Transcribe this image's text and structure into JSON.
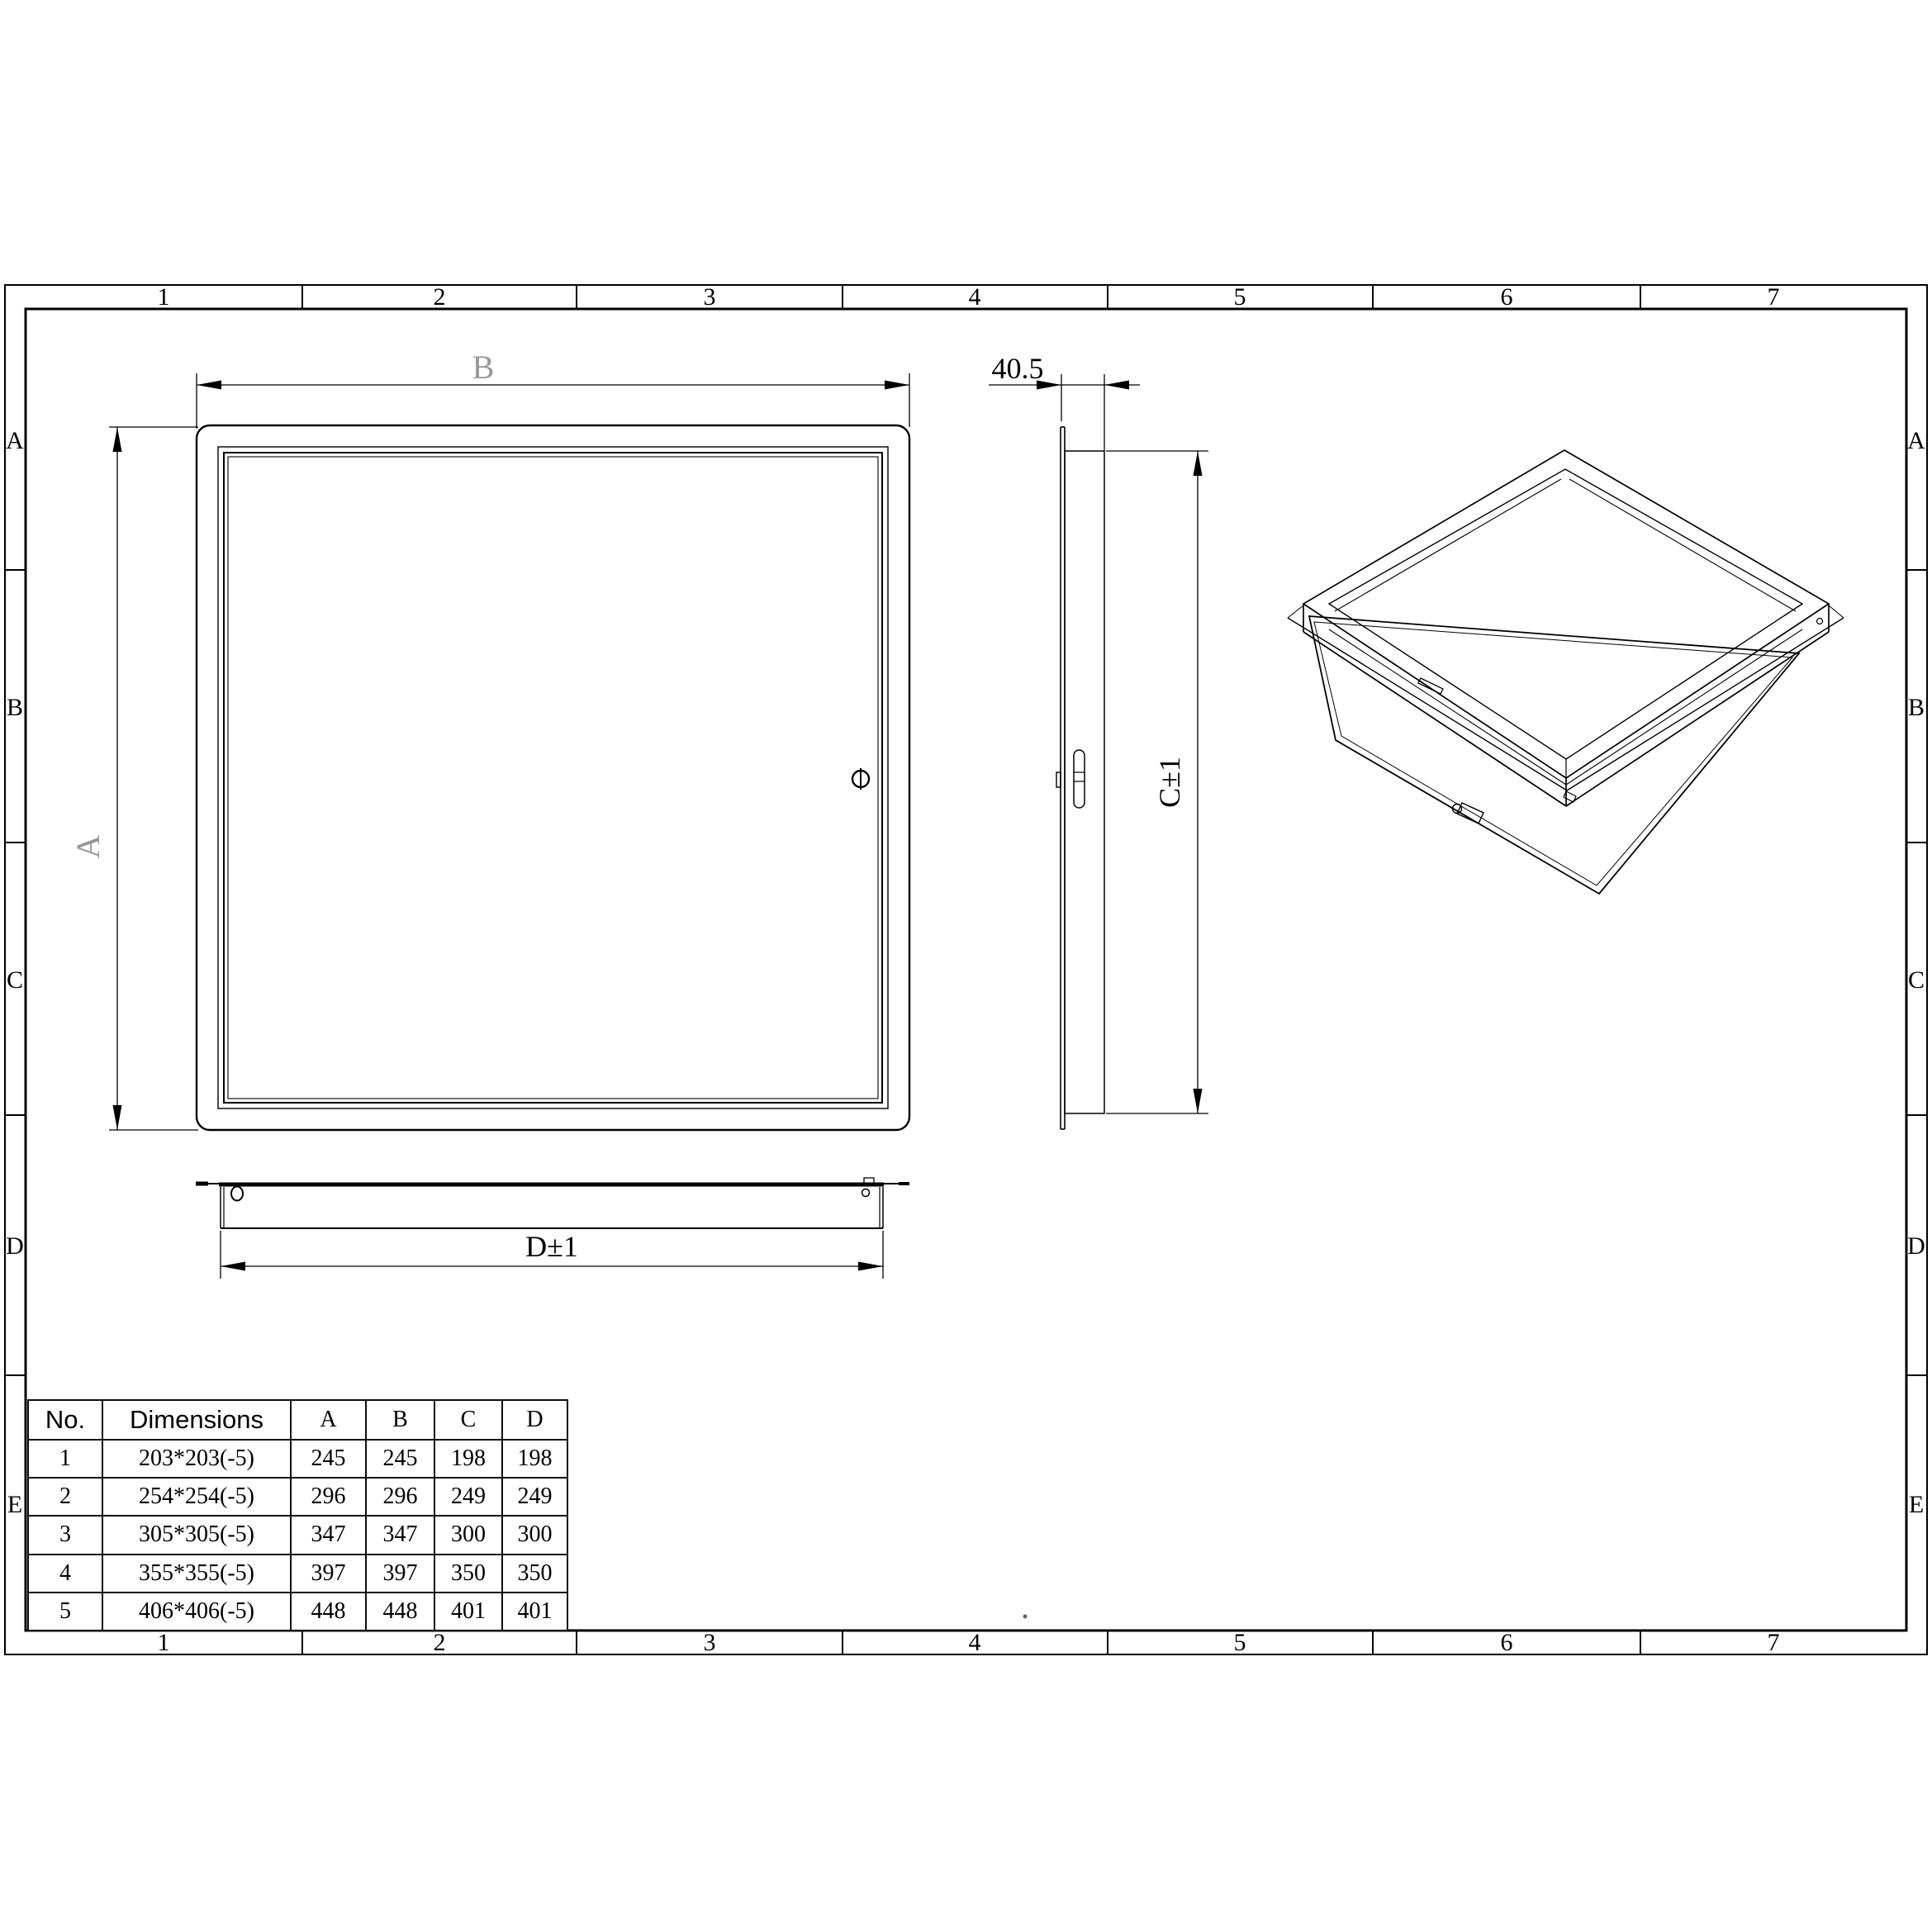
{
  "sheet": {
    "column_labels": [
      "1",
      "2",
      "3",
      "4",
      "5",
      "6",
      "7"
    ],
    "row_labels": [
      "A",
      "B",
      "C",
      "D",
      "E"
    ]
  },
  "dimensions": {
    "front_width_label": "B",
    "front_height_label": "A",
    "side_depth_label": "40.5",
    "side_height_label": "C±1",
    "bottom_width_label": "D±1"
  },
  "table": {
    "headers": [
      "No.",
      "Dimensions",
      "A",
      "B",
      "C",
      "D"
    ],
    "rows": [
      [
        "1",
        "203*203(-5)",
        "245",
        "245",
        "198",
        "198"
      ],
      [
        "2",
        "254*254(-5)",
        "296",
        "296",
        "249",
        "249"
      ],
      [
        "3",
        "305*305(-5)",
        "347",
        "347",
        "300",
        "300"
      ],
      [
        "4",
        "355*355(-5)",
        "397",
        "397",
        "350",
        "350"
      ],
      [
        "5",
        "406*406(-5)",
        "448",
        "448",
        "401",
        "401"
      ]
    ]
  },
  "colors": {
    "line": "#000000",
    "dim_label_gray": "#979797"
  }
}
